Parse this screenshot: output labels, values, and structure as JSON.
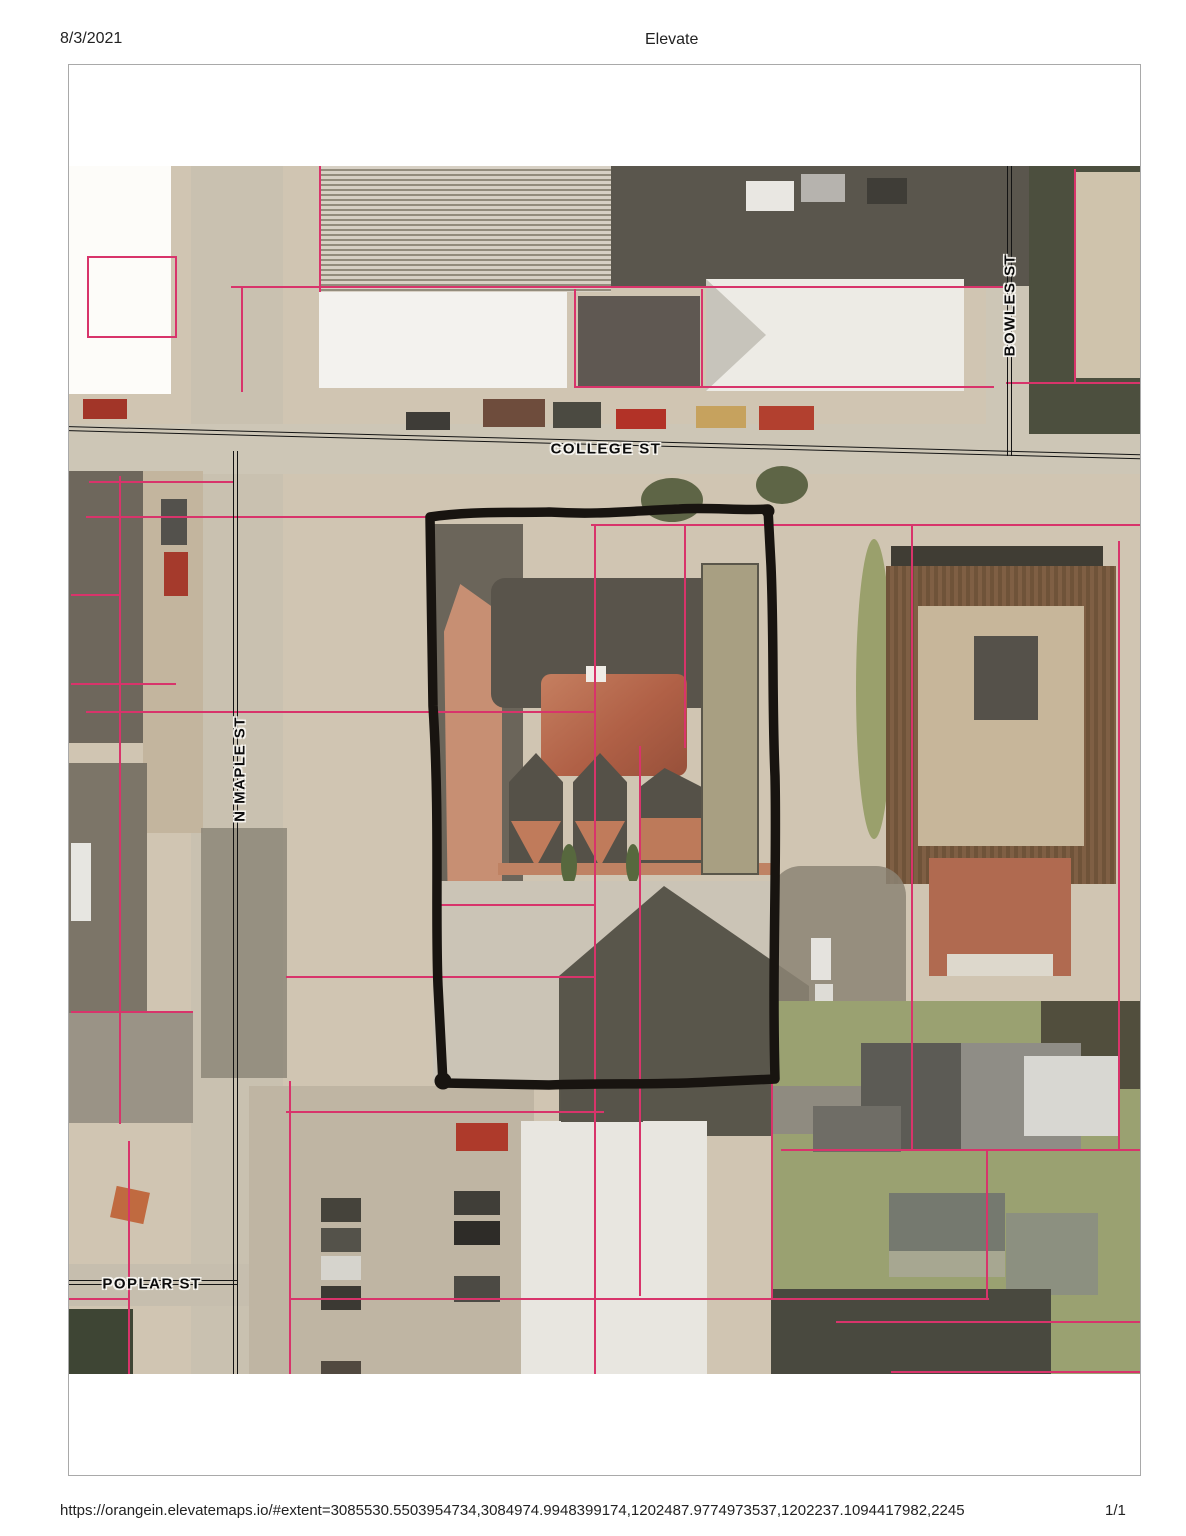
{
  "header": {
    "date": "8/3/2021",
    "title": "Elevate"
  },
  "footer": {
    "url": "https://orangein.elevatemaps.io/#extent=3085530.5503954734,3084974.9948399174,1202487.9774973537,1202237.1094417982,2245",
    "page": "1/1"
  },
  "map": {
    "streets": [
      {
        "name": "COLLEGE ST"
      },
      {
        "name": "N MAPLE ST"
      },
      {
        "name": "BOWLES ST"
      },
      {
        "name": "POPLAR ST"
      }
    ],
    "colors": {
      "parcel_line": "#d8346b",
      "subject_outline": "#181410",
      "imagery_ground": "#d0c5b2",
      "street_pavement": "#cdc6b6",
      "roof_terracotta": "#c78f73",
      "roof_white": "#f3f2ee",
      "shadow_dark": "#59544b",
      "grass": "#9aa171"
    }
  }
}
